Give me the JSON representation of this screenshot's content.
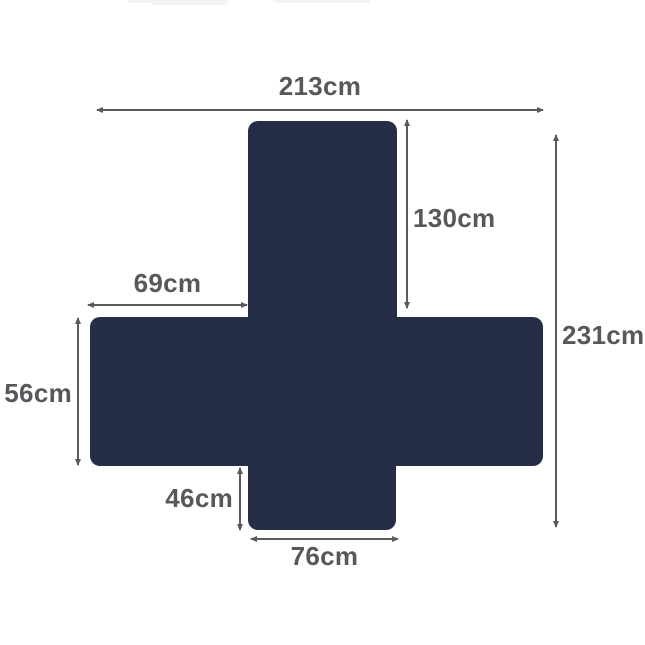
{
  "colors": {
    "shape": "#262e47",
    "dimension_line": "#595a5e",
    "label_text": "#56585c",
    "watermark_artifact": "#f3f4f5",
    "background": "#ffffff"
  },
  "dimensions": {
    "top_width": "213cm",
    "upper_section_height": "130cm",
    "left_arm_width": "69cm",
    "overall_height": "231cm",
    "left_side_height": "56cm",
    "bottom_section_height": "46cm",
    "bottom_width": "76cm"
  }
}
